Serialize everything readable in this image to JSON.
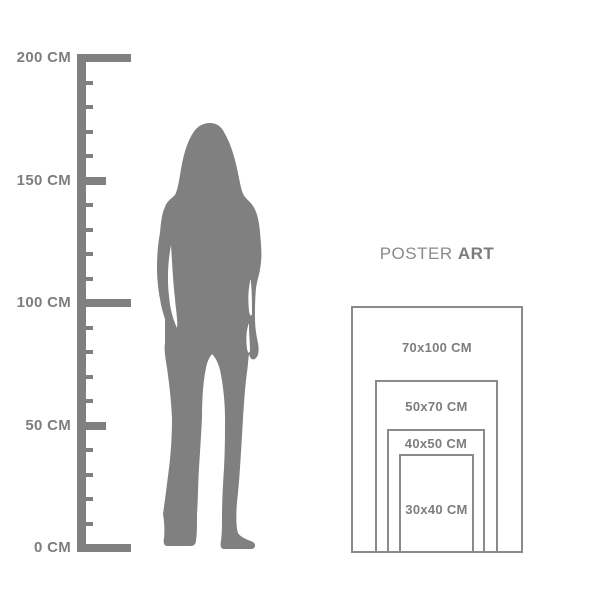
{
  "page": {
    "background": "#ffffff"
  },
  "colors": {
    "gray": "#808080",
    "label_text": "#7d7d7d",
    "rect_border": "#8a8a8a",
    "title_regular": "#8a8a8a",
    "title_bold": "#7c7c7c"
  },
  "ruler": {
    "unit": "CM",
    "labels": [
      "200 CM",
      "150 CM",
      "100 CM",
      "50 CM",
      "0 CM"
    ],
    "values_cm": [
      200,
      150,
      100,
      50,
      0
    ],
    "minor_ticks_per_interval": 4
  },
  "figure": {
    "icon": "woman-silhouette",
    "color": "#808080"
  },
  "poster_panel": {
    "title_regular": "POSTER",
    "title_bold": "ART",
    "sizes": [
      {
        "label": "70x100 CM",
        "width_cm": 70,
        "height_cm": 100
      },
      {
        "label": "50x70 CM",
        "width_cm": 50,
        "height_cm": 70
      },
      {
        "label": "40x50 CM",
        "width_cm": 40,
        "height_cm": 50
      },
      {
        "label": "30x40 CM",
        "width_cm": 30,
        "height_cm": 40
      }
    ]
  }
}
